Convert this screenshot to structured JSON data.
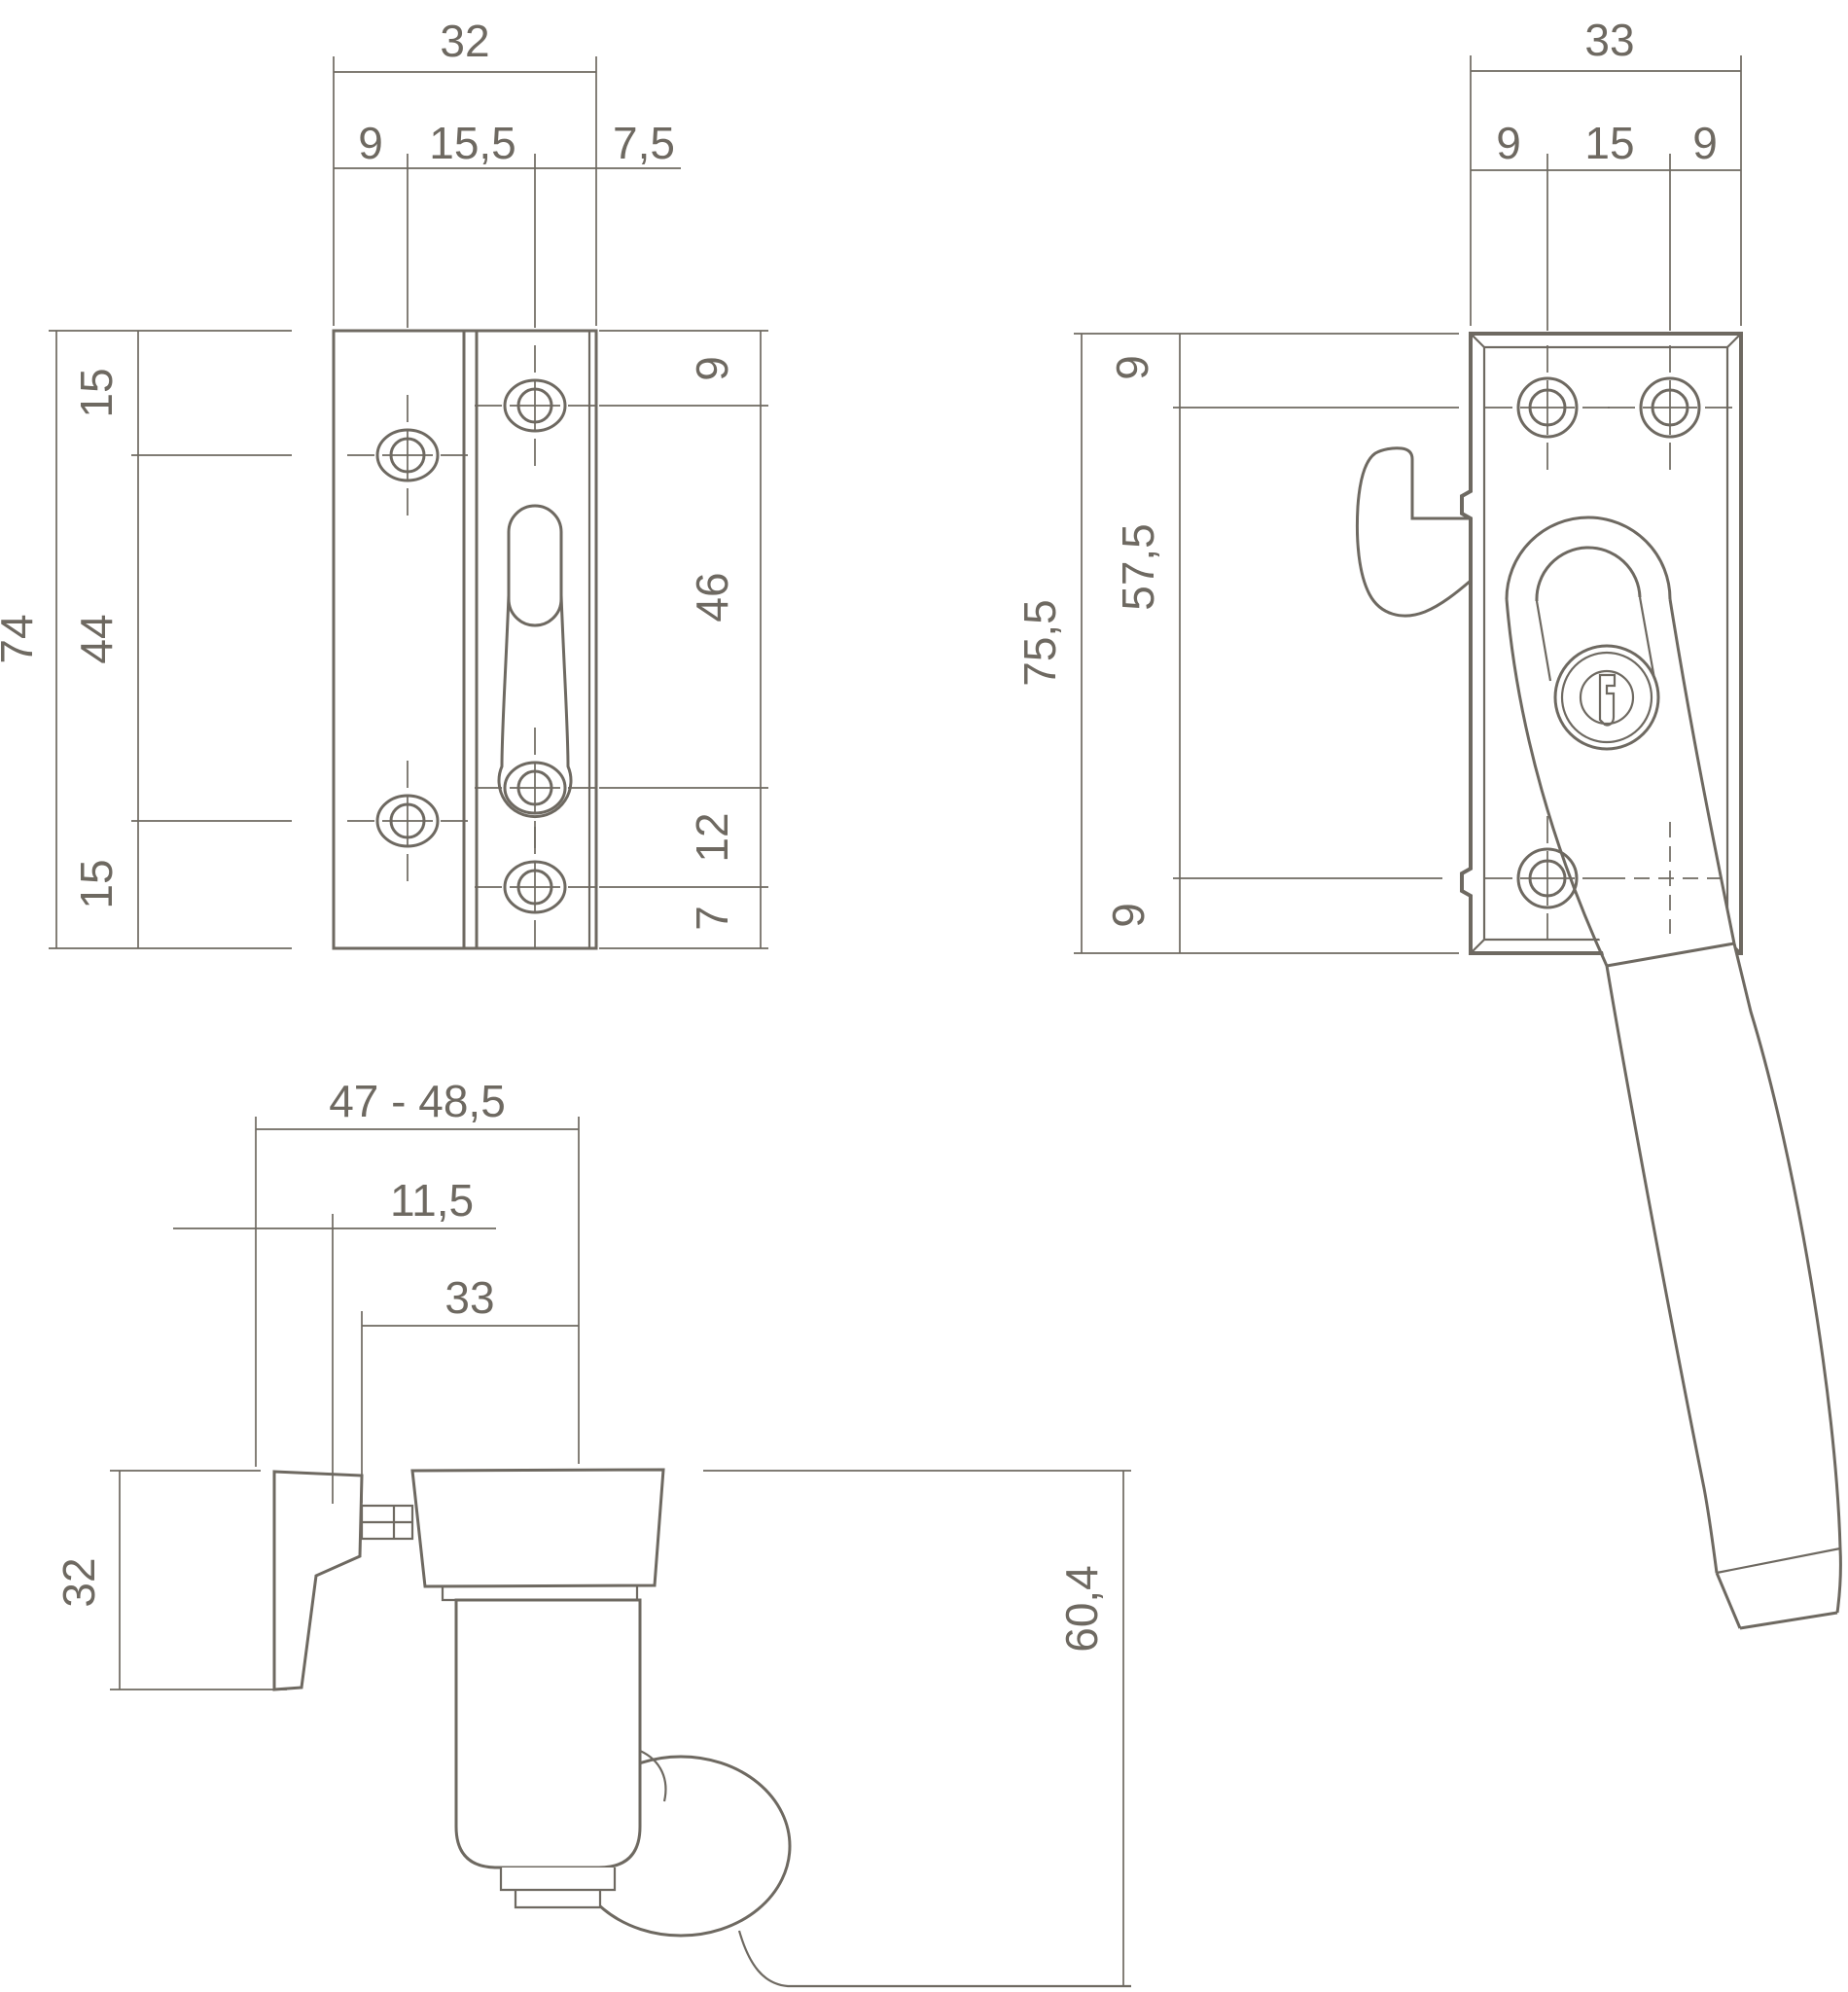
{
  "document": {
    "type": "technical-dimension-drawing",
    "subject": "window fastener with lockable handle and keeper plate",
    "units_note": "millimetres (decimal comma notation)"
  },
  "colors": {
    "line": "#6e6961",
    "text": "#6e6961",
    "background": "#ffffff"
  },
  "views": {
    "keeper_front": {
      "label": "keeper-plate-front-view",
      "dims": {
        "width_total": "32",
        "width_left": "9",
        "width_mid": "15,5",
        "width_right": "7,5",
        "height_total": "74",
        "height_top": "15",
        "height_mid": "44",
        "height_bottom": "15",
        "strip_top": "9",
        "strip_mid": "46",
        "strip_lower": "12",
        "strip_bottom": "7"
      }
    },
    "handle_front": {
      "label": "handle-front-view",
      "dims": {
        "width_total": "33",
        "width_left": "9",
        "width_mid": "15",
        "width_right": "9",
        "height_total": "75,5",
        "height_inner": "57,5",
        "margin_top": "9",
        "margin_bottom": "9"
      }
    },
    "handle_side": {
      "label": "handle-side-view",
      "dims": {
        "depth_range": "47 - 48,5",
        "pivot_offset": "11,5",
        "plate_width": "33",
        "hook_height": "32",
        "body_height": "60,4"
      }
    }
  }
}
